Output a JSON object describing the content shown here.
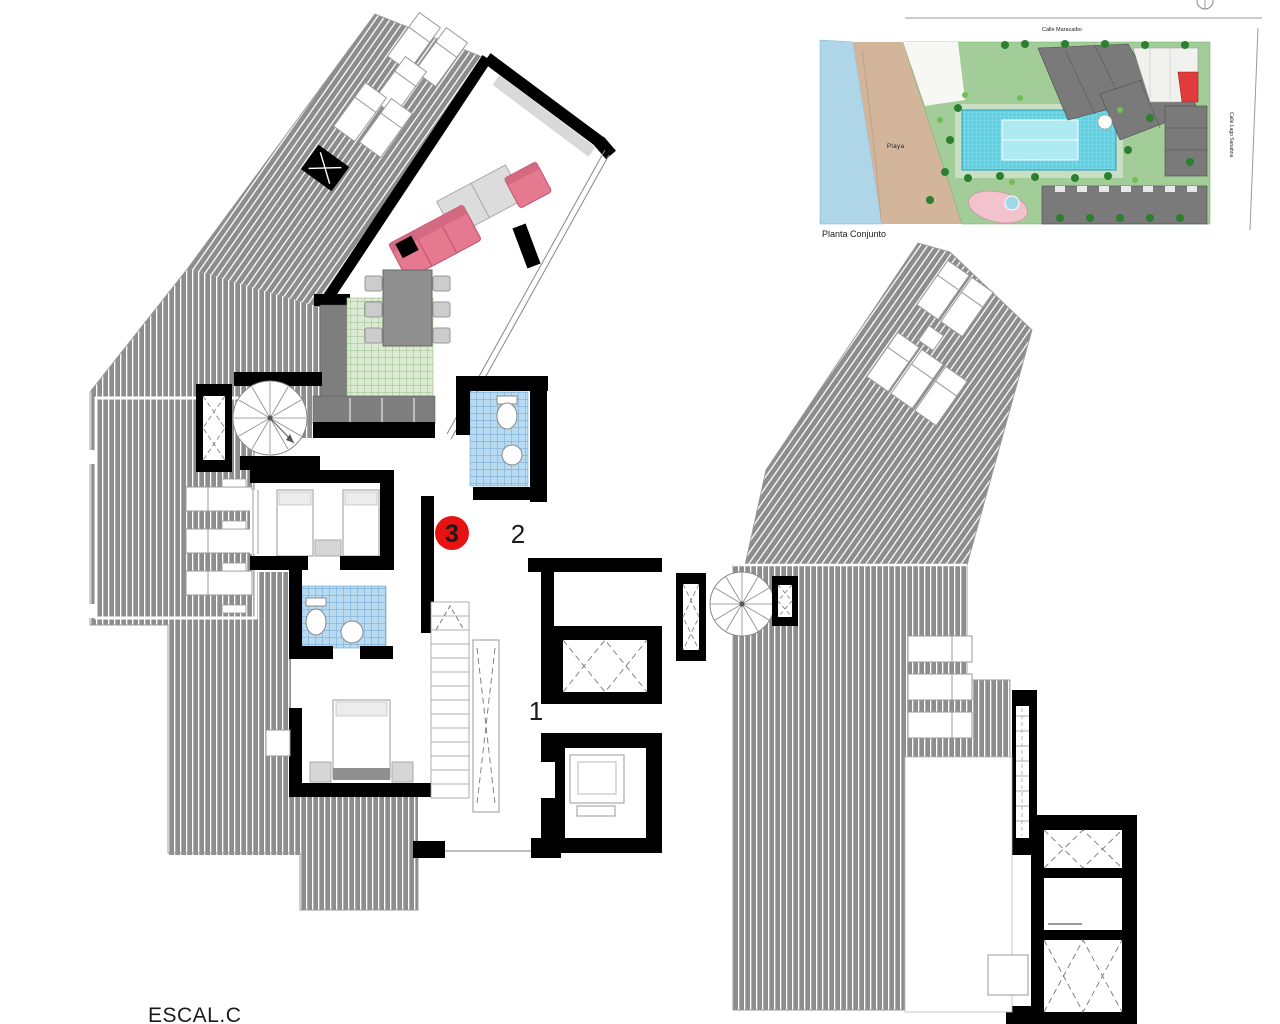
{
  "page": {
    "width": 1280,
    "height": 1024,
    "background": "#ffffff"
  },
  "floor_plan": {
    "sheet_label": "ESCAL.C",
    "unit_badge": {
      "number": "3",
      "color": "#e81212"
    },
    "room_numbers": {
      "entry_hall": "1",
      "upper_hall": "2"
    }
  },
  "site_plan": {
    "caption": "Planta Conjunto",
    "street_top": "Calle Maracaibo",
    "street_right": "Calle Lago Sanabria",
    "beach_label": "Playa",
    "colors": {
      "water": "#aed6e8",
      "sand": "#d2b59b",
      "grass": "#a2cc98",
      "pool": "#5fd0e2",
      "buildings": "#7a7a7a",
      "highlighted_unit": "#e23b3b"
    }
  },
  "palette": {
    "terrace_hatch_gray": "#8d8d8d",
    "wall_black": "#000000",
    "bathroom_tile_blue": "#b9dbf0",
    "kitchen_tile_green": "#dcead3",
    "sofa_pink": "#e5798f",
    "counter_gray": "#7e7e7e"
  }
}
